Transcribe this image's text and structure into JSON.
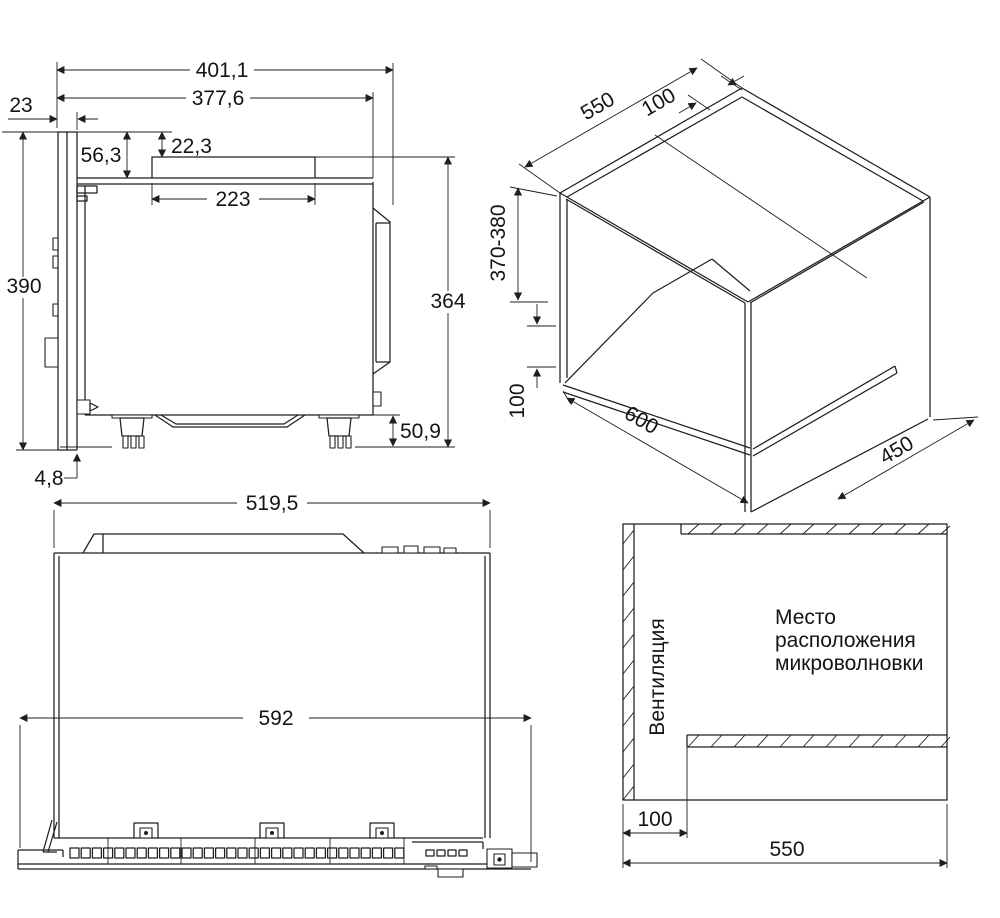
{
  "meta": {
    "background": "#ffffff",
    "line_color": "#1f1f1f"
  },
  "side_view": {
    "dims": {
      "overall_depth": "401,1",
      "depth_no_door": "377,6",
      "door_thickness": "23",
      "top_recess": "56,3",
      "vent_box_height": "22,3",
      "vent_box_length": "223",
      "overall_height": "390",
      "body_height": "364",
      "foot_height": "50,9",
      "door_overhang": "4,8"
    }
  },
  "niche_view": {
    "dims": {
      "top_depth": "550",
      "top_setback": "100",
      "niche_height": "370-380",
      "base_height": "100",
      "niche_width": "600",
      "base_depth": "450"
    }
  },
  "front_view": {
    "dims": {
      "body_width": "519,5",
      "frame_width": "592"
    }
  },
  "placement_view": {
    "texts": {
      "ventilation": "Вентиляция",
      "location_lines": [
        "Место",
        "расположения",
        "микроволновки"
      ]
    },
    "dims": {
      "side_gap": "100",
      "niche_width": "550"
    }
  }
}
